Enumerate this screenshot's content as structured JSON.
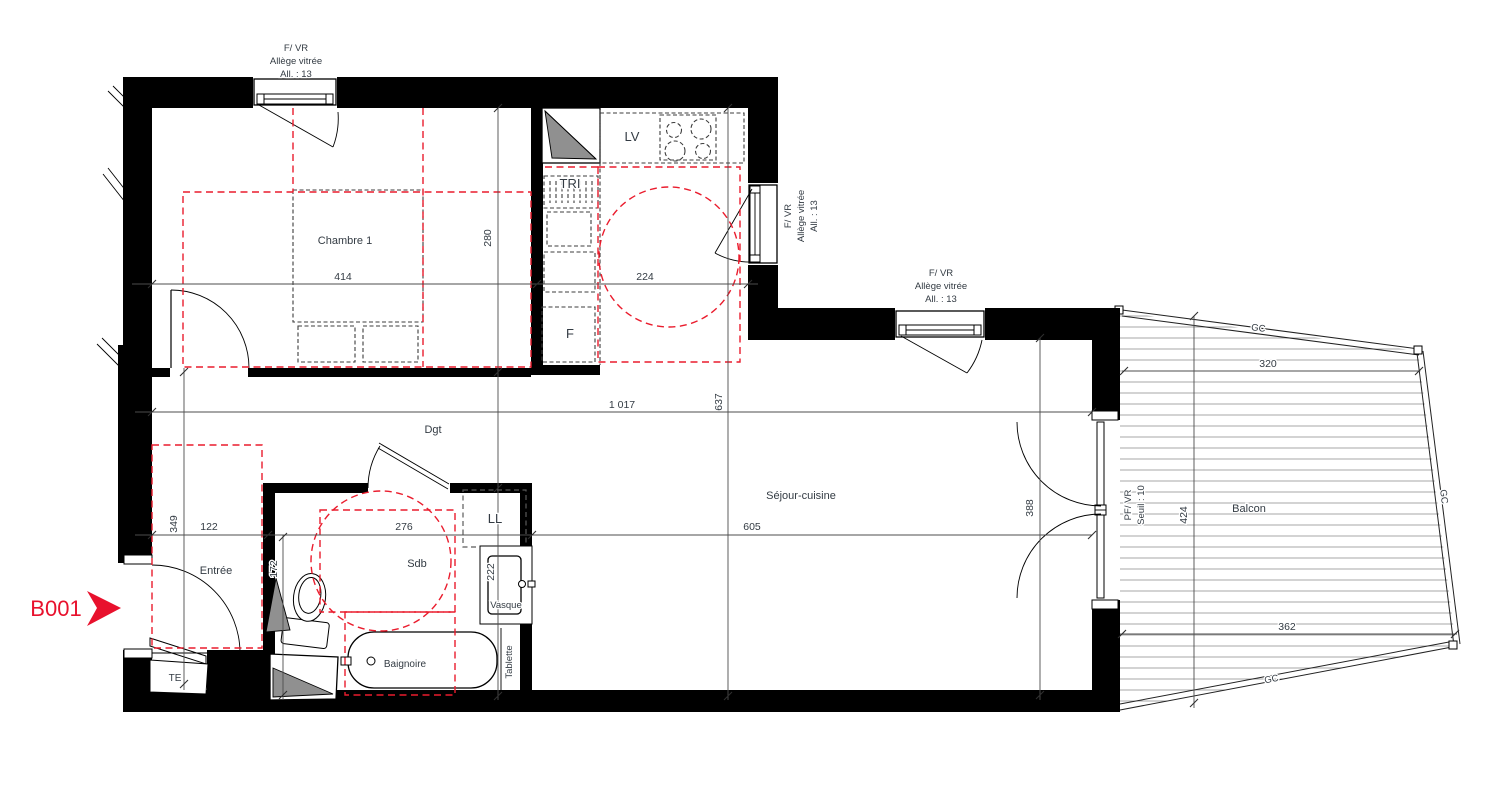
{
  "unit": {
    "label": "B001"
  },
  "rooms": {
    "chambre": "Chambre 1",
    "sejour": "Séjour-cuisine",
    "entree": "Entrée",
    "dgt": "Dgt",
    "sdb": "Sdb",
    "balcon": "Balcon"
  },
  "fixtures": {
    "lv": "LV",
    "tri": "TRI",
    "fridge": "F",
    "washer": "LL",
    "te": "TE",
    "vasque": "Vasque",
    "baignoire": "Baignoire",
    "tablette": "Tablette"
  },
  "openings": {
    "window_type": "F/ VR",
    "allege": "Allège vitrée",
    "allege_height": "All. : 13",
    "door_type": "PF/ VR",
    "seuil": "Seuil : 10",
    "railing": "GC"
  },
  "dims": {
    "chambre_w": "414",
    "chambre_h": "280",
    "cuisine_w": "224",
    "interieur_w": "1 017",
    "interieur_h": "637",
    "sejour_w": "605",
    "entree_w": "122",
    "sdb_w": "276",
    "entree_h": "349",
    "wc_h": "172",
    "dgt_w": "120",
    "sdb_h": "222",
    "baie_h": "388",
    "balcon_haut": "320",
    "balcon_cote": "424",
    "balcon_bas": "362"
  },
  "colors": {
    "marker_red": "#E8112D",
    "dash_red": "#EA1C2D",
    "wall_black": "#000000",
    "text": "#333B43"
  }
}
